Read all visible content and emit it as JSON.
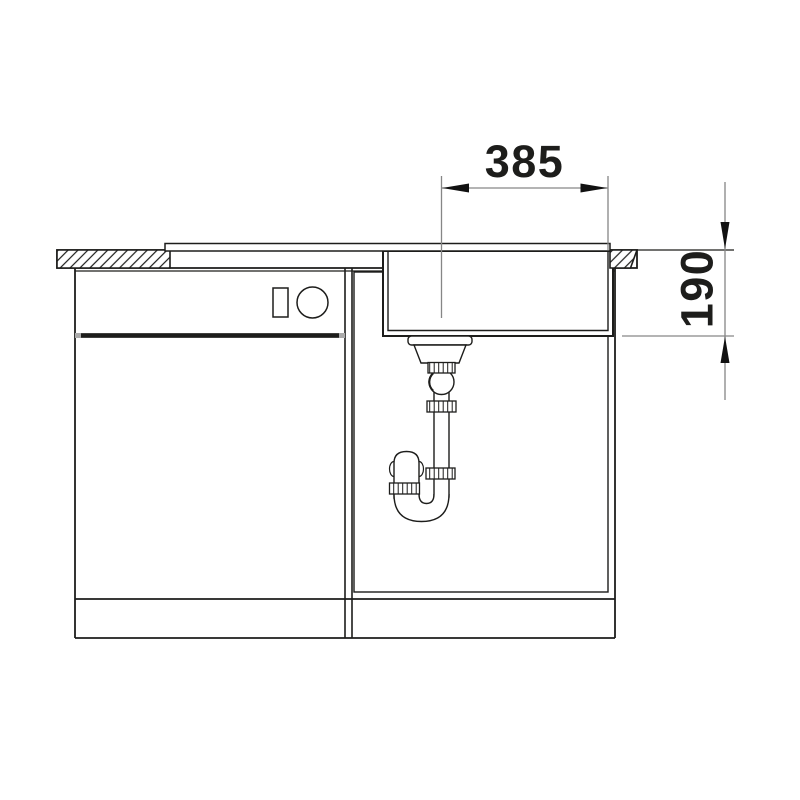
{
  "drawing": {
    "dimensions": {
      "width": "385",
      "depth": "190"
    },
    "colors": {
      "outline": "#1d1d1b",
      "dimension_line": "#868686",
      "dimension_text": "#1d1d1b",
      "door_accent_gray": "#aaaaaa",
      "background": "#ffffff"
    }
  }
}
